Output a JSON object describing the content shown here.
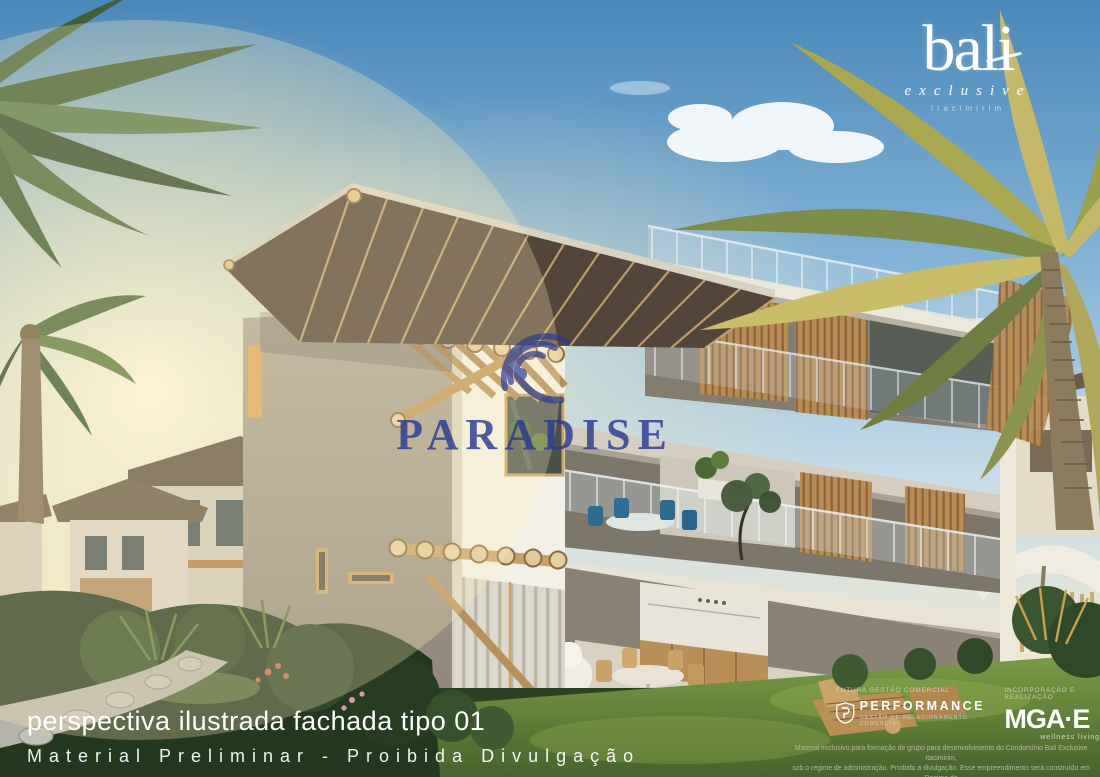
{
  "logo_bali": {
    "title": "bali",
    "subtitle": "exclusive",
    "tagline": "Itacimirim"
  },
  "watermark": {
    "brand": "PARADISE",
    "color": "#2b3a92",
    "icon": "paradise-waves-icon"
  },
  "caption": {
    "line1": "perspectiva ilustrada fachada tipo 01",
    "line2": "Material Preliminar - Proibida Divulgação"
  },
  "credits": {
    "performance": {
      "caption": "FUTURA GESTÃO COMERCIAL",
      "brand": "PERFORMANCE",
      "subtitle": "GESTÃO DE RELACIONAMENTO COMERCIAL",
      "icon": "performance-shield-icon"
    },
    "mga": {
      "caption": "INCORPORAÇÃO E REALIZAÇÃO",
      "brand": "MGA·E",
      "subtitle": "wellness living"
    }
  },
  "disclaimer": {
    "line1": "Material exclusivo para formação de grupo para desenvolvimento do Condomínio Bali Exclusive Itacimirim,",
    "line2": "sob o regime de administração. Proibido a divulgação. Esse empreendimento será construído em Regime de",
    "line3": "Condomínio a preço de custo Lei 4.591 de 16 de dezembro de 1964 capítulo II - seção II art. 58 ao art.62"
  },
  "colors": {
    "sky_top": "#4a88ba",
    "sun_glow": "#fff8df",
    "watermark_blue": "#2b3a92",
    "wall_gray": "#a29a8d",
    "wall_white": "#f3f0e8",
    "wood": "#c19a63",
    "foliage_dark": "#24361f",
    "lawn": "#6f923f"
  }
}
